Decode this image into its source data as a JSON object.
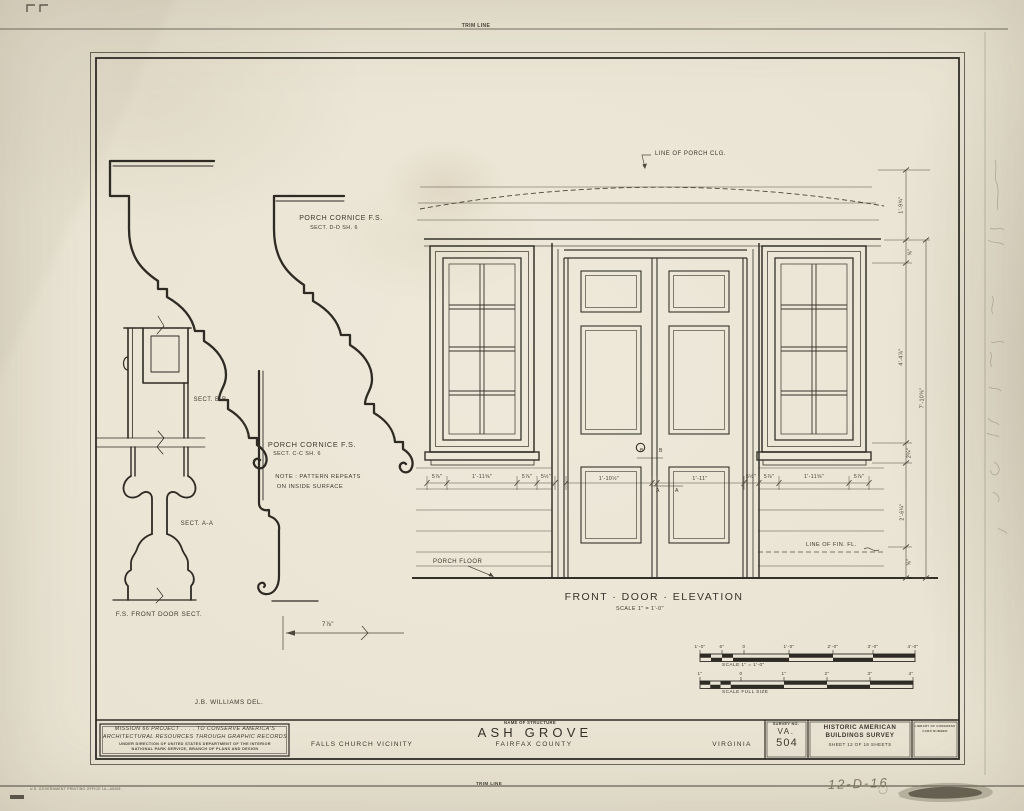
{
  "sheet": {
    "trim_line_top": "TRIM LINE",
    "trim_line_bottom": "TRIM LINE",
    "gpo_note": "U.S. GOVERNMENT PRINTING OFFICE   16—65265",
    "pencil_note": "12-D-16"
  },
  "details": {
    "cornice_dd_title": "PORCH CORNICE  F.S.",
    "cornice_dd_sub": "SECT. D-D   SH. 6",
    "cornice_cc_title": "PORCH CORNICE  F.S.",
    "cornice_cc_sub": "SECT. C-C  SH. 6",
    "cornice_note_1": "NOTE : PATTERN REPEATS",
    "cornice_note_2": "ON INSIDE SURFACE",
    "sect_bb": "SECT. B-B",
    "sect_aa": "SECT. A-A",
    "front_door_sect": "F.S.  FRONT DOOR  SECT.",
    "dim_7_78": "7⅞\"",
    "delineator": "J.B. WILLIAMS  DEL."
  },
  "elevation": {
    "porch_ceiling_label": "LINE OF PORCH CLG.",
    "porch_floor_label": "PORCH FLOOR",
    "finish_floor_label": "LINE OF FIN. FL.",
    "title": "FRONT · DOOR · ELEVATION",
    "scale_note": "SCALE   1\" = 1'-0\"",
    "letter_b": "B",
    "letter_a": "A",
    "h_dims": [
      "5⅞\"",
      "1'-11⅝\"",
      "5⅞\"",
      "5½\"",
      "1'-10½\"",
      "1'-11\"",
      "5½\"",
      "5⅞\"",
      "1'-11⅝\"",
      "5⅞\""
    ],
    "v_dims": [
      "1'-9¾\"",
      "⅝\"",
      "4'-4⅞\"",
      "2¼\"",
      "2'-6¼\"",
      "⅝\""
    ],
    "v_dim_overall": "7'-10⅝\""
  },
  "scale_bars": {
    "bar1_labels": [
      "1'-0\"",
      "6\"",
      "0",
      "1'-0\"",
      "2'-0\"",
      "3'-0\"",
      "4'-0\""
    ],
    "bar1_caption": "SCALE   1\" = 1'-0\"",
    "bar2_labels": [
      "1\"",
      "0",
      "1\"",
      "2\"",
      "3\"",
      "4\""
    ],
    "bar2_caption": "SCALE   FULL  SIZE"
  },
  "title_block": {
    "project_line1": "MISSION 66 PROJECT . . . . TO CONSERVE AMERICA'S",
    "project_line2": "ARCHITECTURAL RESOURCES THROUGH GRAPHIC RECORDS",
    "direction_line1": "UNDER DIRECTION OF UNITED STATES DEPARTMENT OF THE INTERIOR",
    "direction_line2": "NATIONAL PARK SERVICE, BRANCH OF PLANS AND DESIGN",
    "vicinity": "FALLS CHURCH VICINITY",
    "name_of_structure_label": "NAME OF STRUCTURE",
    "structure_name": "ASH GROVE",
    "county": "FAIRFAX COUNTY",
    "state": "VIRGINIA",
    "survey_no_label": "SURVEY NO.",
    "survey_no_value1": "VA.",
    "survey_no_value2": "504",
    "habs_line1": "HISTORIC AMERICAN",
    "habs_line2": "BUILDINGS SURVEY",
    "sheet_info": "SHEET 12 OF 16 SHEETS",
    "corner_line1": "LIBRARY OF CONGRESS",
    "corner_line2": "CARD NUMBER"
  }
}
